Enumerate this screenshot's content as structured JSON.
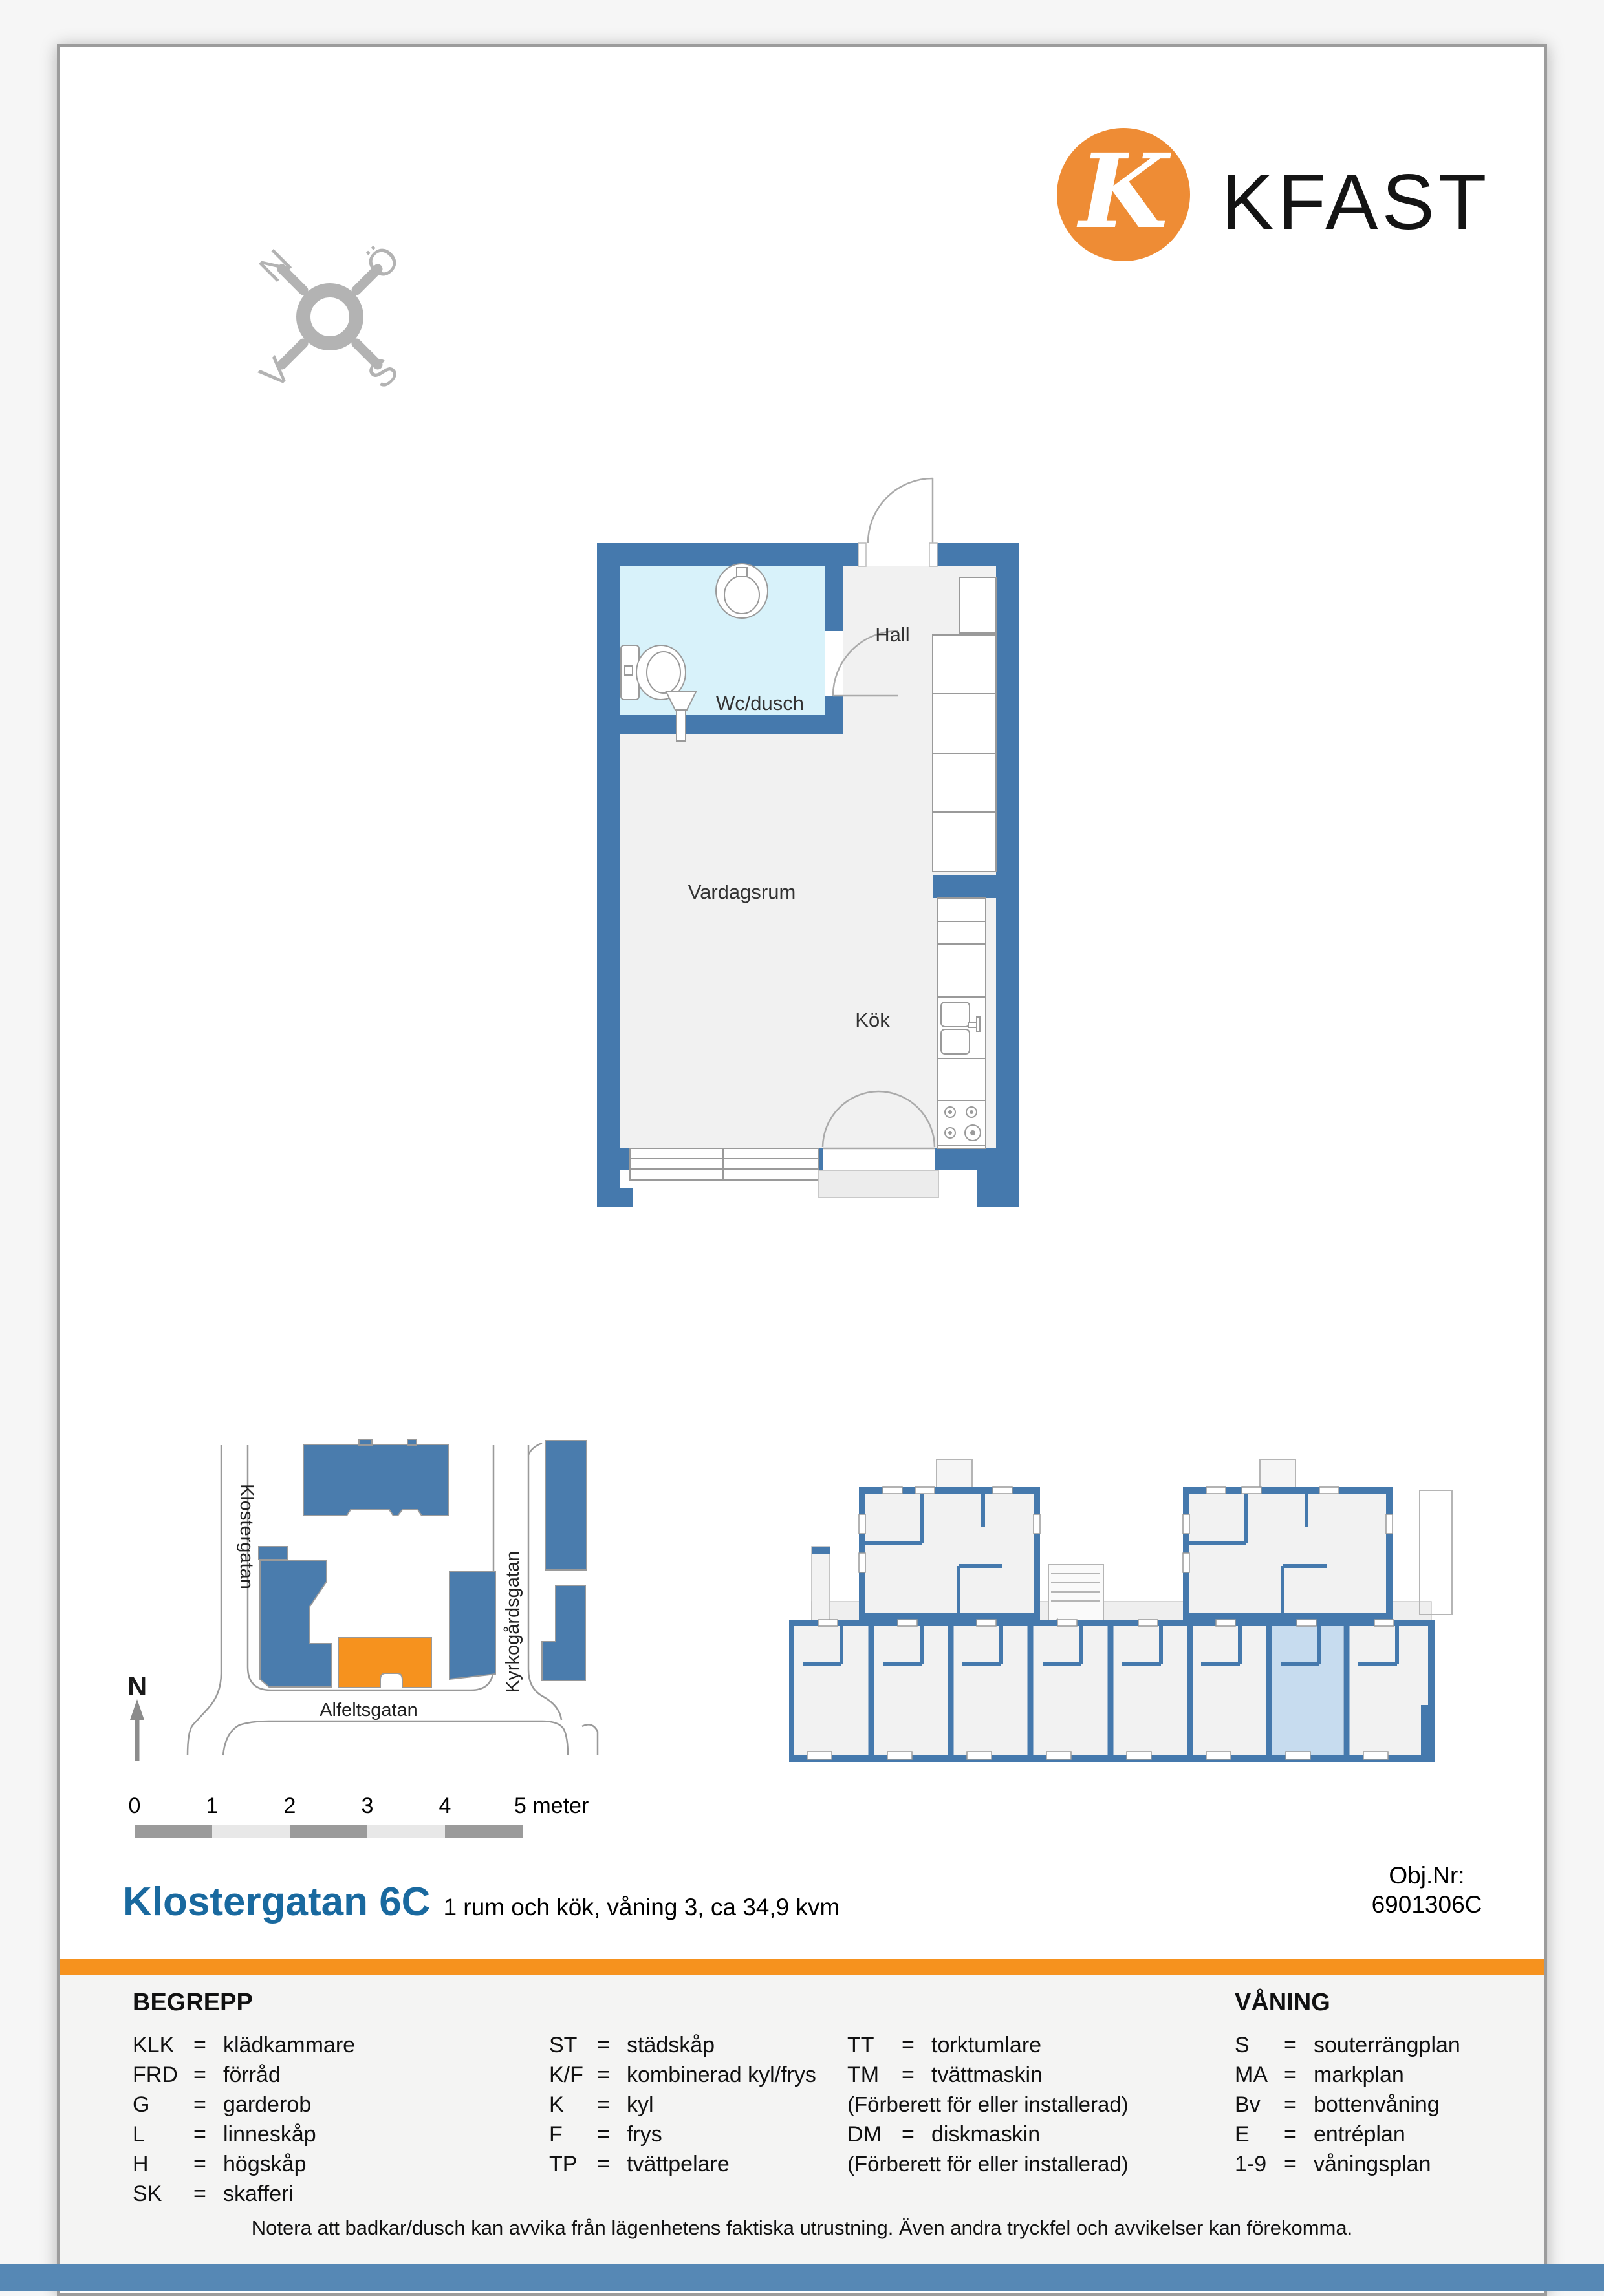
{
  "brand": {
    "name": "KFAST",
    "monogram": "K"
  },
  "compass": {
    "north": "N",
    "east": "Ö",
    "south": "S",
    "west": "V"
  },
  "floorplan": {
    "hall": "Hall",
    "bathroom": "Wc/dusch",
    "living": "Vardagsrum",
    "kitchen": "Kök"
  },
  "sitemap": {
    "street_left": "Klostergatan",
    "street_right": "Kyrkogårdsgatan",
    "street_bottom": "Alfeltsgatan",
    "north": "N"
  },
  "scalebar": {
    "ticks": [
      "0",
      "1",
      "2",
      "3",
      "4"
    ],
    "end": "5 meter"
  },
  "title": {
    "address": "Klostergatan 6C",
    "subtitle": "1 rum och kök, våning 3, ca 34,9 kvm",
    "obj_label": "Obj.Nr:",
    "obj_value": "6901306C"
  },
  "legend": {
    "eq": "=",
    "begrepp": "BEGREPP",
    "vaning": "VÅNING",
    "col1": [
      {
        "abbr": "KLK",
        "label": "klädkammare"
      },
      {
        "abbr": "FRD",
        "label": "förråd"
      },
      {
        "abbr": "G",
        "label": "garderob"
      },
      {
        "abbr": "L",
        "label": "linneskåp"
      },
      {
        "abbr": "H",
        "label": "högskåp"
      },
      {
        "abbr": "SK",
        "label": "skafferi"
      }
    ],
    "col2": [
      {
        "abbr": "ST",
        "label": "städskåp"
      },
      {
        "abbr": "K/F",
        "label": "kombinerad kyl/frys"
      },
      {
        "abbr": "K",
        "label": "kyl"
      },
      {
        "abbr": "F",
        "label": "frys"
      },
      {
        "abbr": "TP",
        "label": "tvättpelare"
      }
    ],
    "col3": [
      {
        "abbr": "TT",
        "label": "torktumlare"
      },
      {
        "abbr": "TM",
        "label": "tvättmaskin"
      },
      {
        "note": "(Förberett för eller installerad)"
      },
      {
        "abbr": "DM",
        "label": "diskmaskin"
      },
      {
        "note": "(Förberett för eller installerad)"
      }
    ],
    "col4": [
      {
        "abbr": "S",
        "label": "souterrängplan"
      },
      {
        "abbr": "MA",
        "label": "markplan"
      },
      {
        "abbr": "Bv",
        "label": "bottenvåning"
      },
      {
        "abbr": "E",
        "label": "entréplan"
      },
      {
        "abbr": "1-9",
        "label": "våningsplan"
      }
    ]
  },
  "note": "Notera att badkar/dusch kan avvika från lägenhetens faktiska utrustning. Även andra tryckfel och avvikelser kan förekomma.",
  "colors": {
    "wall_blue": "#4579AD",
    "building_blue": "#4A7CAD",
    "accent_orange": "#F6921E",
    "logo_orange": "#EE8C35",
    "title_blue": "#19699F",
    "footer_blue": "#5688B5",
    "bathroom_fill": "#D8F2FA",
    "highlight_apartment": "#C7DCEF"
  }
}
